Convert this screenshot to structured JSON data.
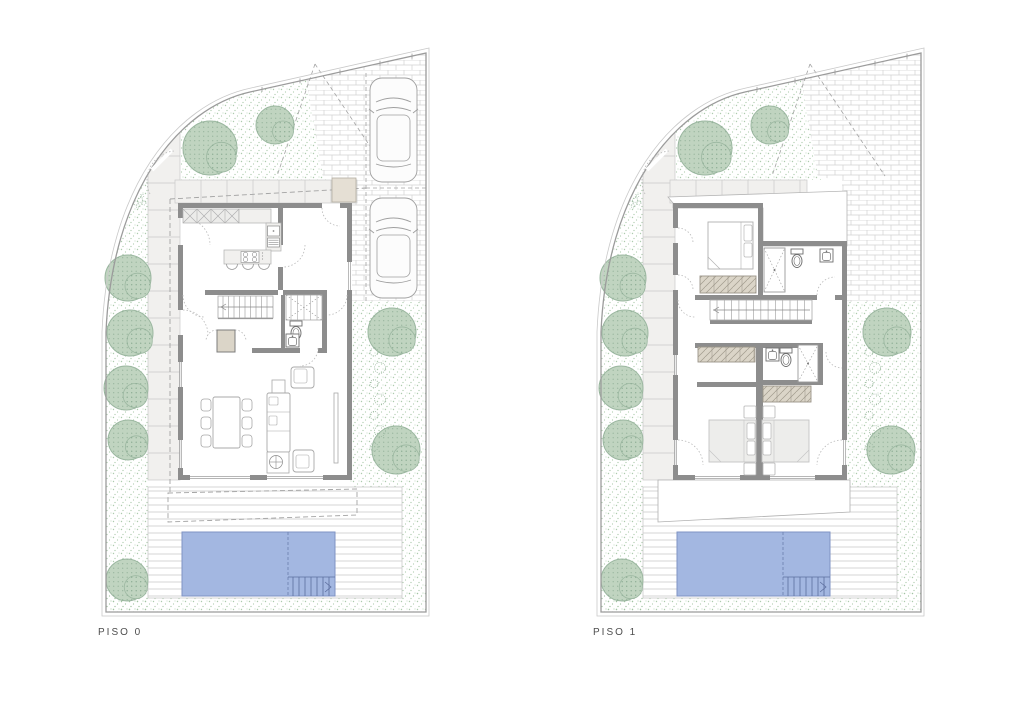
{
  "sheet": {
    "type": "architectural floor plan sheet",
    "background": "#ffffff"
  },
  "labels": {
    "floor0": "PISO 0",
    "floor1": "PISO 1"
  },
  "colors": {
    "wall": "#8d8d8d",
    "boundary_line": "#9b9b9b",
    "boundary_outer": "#c9c9c9",
    "thin_line": "#a8a8a8",
    "furniture_line": "#a8a8a8",
    "fixture_line": "#6f6f6f",
    "dash_line": "#a3a3a3",
    "window_line": "#9e9e9e",
    "arc_line": "#b8b8b8",
    "pool_fill": "#a3b7e1",
    "pool_line": "#7f93c4",
    "pool_step_line": "#5c6e9e",
    "tree_fill": "#c0d4c0",
    "tree_line": "#9bb7a0",
    "tree_dot": "#86a88e",
    "stipple_dot": "#9fc29f",
    "paver_fill": "#f1f0ee",
    "paver_line": "#c9c9c9",
    "brick_line": "#d2d2d2",
    "deck_line": "#c8c8c8",
    "wardrobe_fill": "#dbd5c8",
    "wardrobe_line": "#a09a8c",
    "counter_fill": "#f1f0ee",
    "cabinet_fill": "#ececea",
    "porch_fill": "#e5dfd4",
    "bed_fill": "#ededeb",
    "label_text": "#4d4d4d"
  },
  "plans": [
    {
      "name": "piso-0",
      "label": "PISO 0",
      "offset_x": 0,
      "pavers_width": 182,
      "features": {
        "cars": true,
        "parking_dashes": true,
        "overhang_dashes": true,
        "roof": false,
        "terrace_slab": false,
        "entry_porch": true
      }
    },
    {
      "name": "piso-1",
      "label": "PISO 1",
      "offset_x": 495,
      "pavers_width": 137,
      "features": {
        "cars": false,
        "parking_dashes": false,
        "overhang_dashes": false,
        "roof": true,
        "terrace_slab": true,
        "entry_porch": false
      }
    }
  ],
  "site": {
    "trees": [
      [
        210,
        148,
        27
      ],
      [
        275,
        125,
        19
      ],
      [
        128,
        278,
        23
      ],
      [
        130,
        333,
        23
      ],
      [
        126,
        388,
        22
      ],
      [
        128,
        440,
        20
      ],
      [
        127,
        580,
        21
      ],
      [
        392,
        332,
        24
      ],
      [
        396,
        450,
        24
      ]
    ],
    "bush_cluster": {
      "x": 140,
      "y": 200
    },
    "bush_chain": {
      "x": 377,
      "y_start": 352,
      "y_end": 447,
      "count": 7
    },
    "pool": {
      "x": 182,
      "y": 532,
      "w": 153,
      "h": 64,
      "step_x": 288
    },
    "cars": [
      [
        370,
        78,
        47,
        104
      ],
      [
        370,
        198,
        47,
        100
      ]
    ]
  }
}
